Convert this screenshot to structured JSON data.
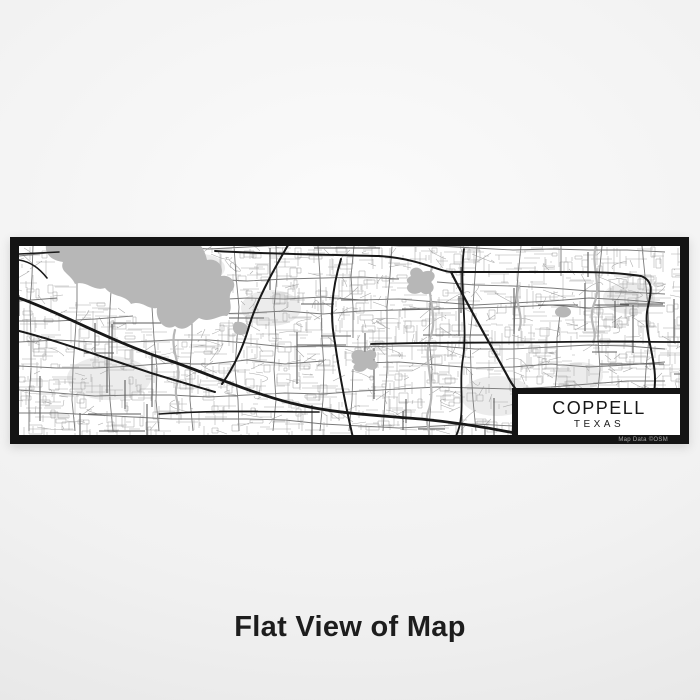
{
  "product": {
    "map": {
      "city": "COPPELL",
      "state": "TEXAS",
      "attribution": "Map Data ©OSM"
    },
    "caption": "Flat View of Map"
  },
  "colors": {
    "water": "#b7b7b7",
    "park": "#ececec",
    "minor_road": "#ababab",
    "block_outline": "#a3a3a3",
    "medium_road": "#7a7a7a",
    "dark_connector": "#5e5e5e",
    "major_road": "#181818",
    "frame": "#141414",
    "map_background": "#ffffff"
  }
}
